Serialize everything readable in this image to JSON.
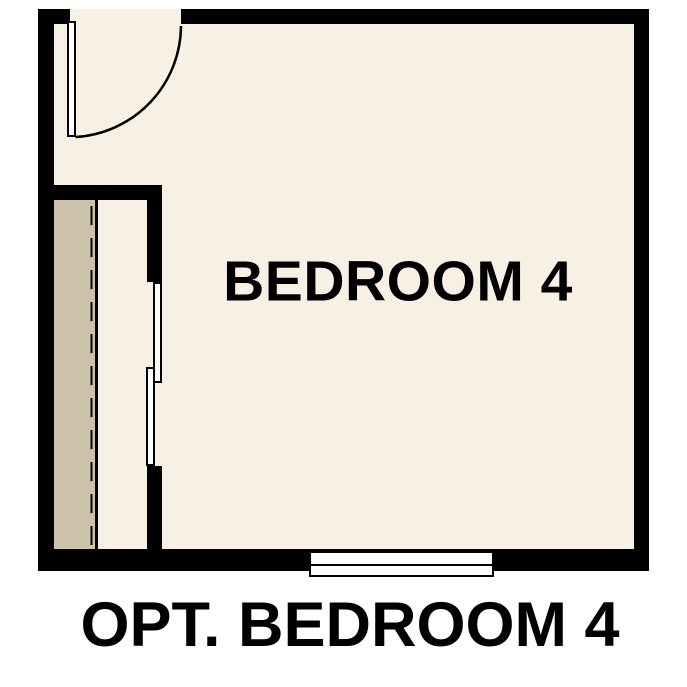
{
  "floor_plan": {
    "room_label": "BEDROOM 4",
    "caption": "OPT. BEDROOM 4",
    "symbols": [
      "hinged-door-with-swing-arc",
      "bypass-closet-doors",
      "closet-shelf-with-rod-dashed-line",
      "window"
    ]
  },
  "colors": {
    "background": "#ffffff",
    "floor": "#f7f0e4",
    "wall": "#000000",
    "closet_shelf": "#cdc3ab",
    "door_fill": "#ffffff",
    "text": "#000000"
  }
}
